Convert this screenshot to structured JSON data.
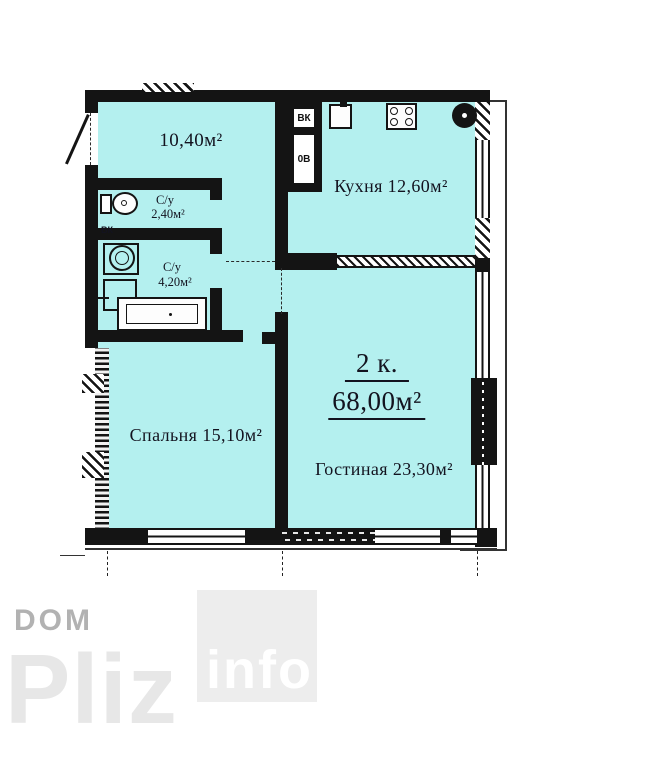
{
  "plan": {
    "summary": {
      "rooms_count_label": "2 к.",
      "total_area_label": "68,00м²"
    },
    "rooms": [
      {
        "id": "hallway",
        "area_label": "10,40м²"
      },
      {
        "id": "bathroom-small",
        "name": "С/у",
        "area_label": "2,40м²"
      },
      {
        "id": "bathroom-large",
        "name": "С/у",
        "area_label": "4,20м²"
      },
      {
        "id": "kitchen",
        "label": "Кухня 12,60м²"
      },
      {
        "id": "bedroom",
        "label": "Спальня 15,10м²"
      },
      {
        "id": "living-room",
        "label": "Гостиная 23,30м²"
      }
    ],
    "shaft_labels": {
      "vk": "ВК",
      "ov": "0В",
      "vk_side": "ВК"
    },
    "colors": {
      "room_fill": "#b4f0ef",
      "wall": "#141414"
    }
  },
  "watermark": {
    "word1": "DOM",
    "word2": "Pliz",
    "word3": "info",
    "colors": {
      "wm_dark": "#b2b2b2",
      "wm_light": "#e7e7e7",
      "wm_box": "#ededed"
    }
  }
}
